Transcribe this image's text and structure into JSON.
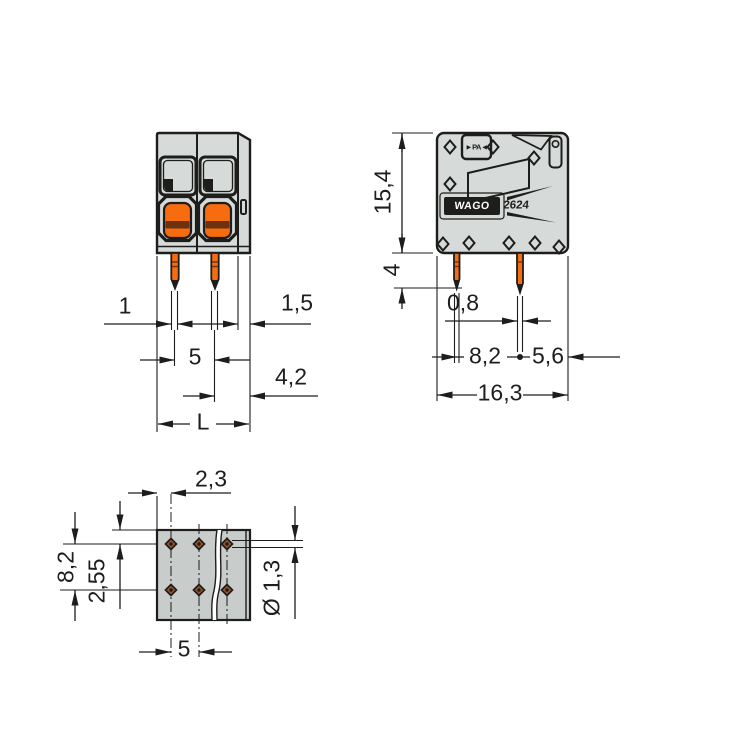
{
  "product": {
    "brand": "WAGO",
    "series": "2624",
    "material_marking": "►PA◄"
  },
  "colors": {
    "line": "#1d1d1b",
    "body": "#d6dad8",
    "body2": "#c8ccca",
    "orange": "#f66c0f",
    "band": "#6e3110",
    "hole": "#9a5524"
  },
  "front_view": {
    "dim_pin_width": "1",
    "dim_right_step": "1,5",
    "dim_pole_pitch": "5",
    "dim_pin_to_right_edge": "4,2",
    "dim_overall_length": "L"
  },
  "side_view": {
    "dim_height": "15,4",
    "dim_pin_length": "4",
    "dim_pin_thickness": "0,8",
    "dim_pin_row_spacing": "8,2",
    "dim_rear_pin_to_edge": "5,6",
    "dim_overall_depth": "16,3"
  },
  "bottom_view": {
    "dim_edge_to_first_hole": "2,3",
    "dim_hole_row_spacing": "8,2",
    "dim_edge_to_first_row": "2,55",
    "dim_hole_pitch": "5",
    "dim_hole_diameter": "Ø 1,3"
  }
}
